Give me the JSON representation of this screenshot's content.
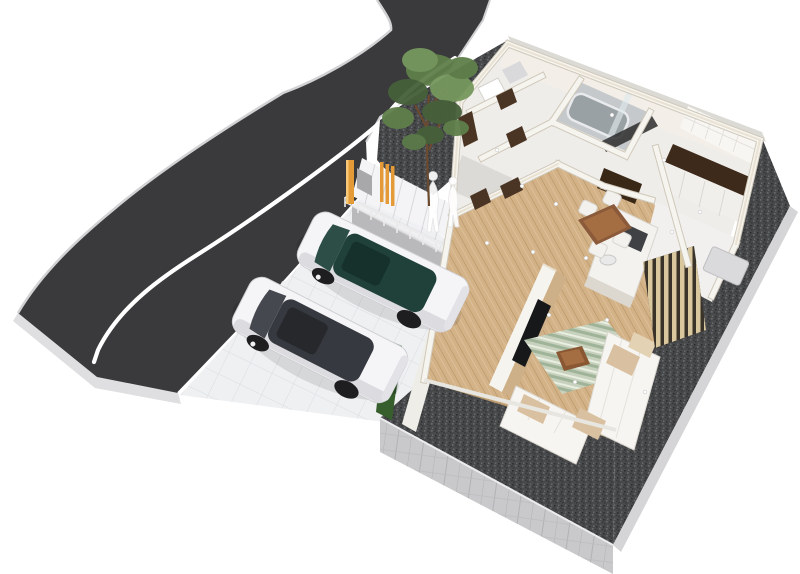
{
  "meta": {
    "title": "3D aerial cutaway floor-plan render of a house lot",
    "view": "perspective aerial oblique",
    "contains_text": false
  },
  "scene": {
    "road": {
      "label": "curved asphalt road",
      "marking": "single white lane line"
    },
    "driveway": {
      "label": "white tiled parking area at street level"
    },
    "vehicles": [
      {
        "label": "white SUV, dark teal glass roof, parked facing upper-left"
      },
      {
        "label": "white SUV, dark gray glass roof, parked facing upper-left"
      }
    ],
    "site": {
      "plinth": "raised base with concrete block face",
      "gravel": "dark gravel border around house",
      "stairs": "white entrance steps with metal handrail",
      "figures": "two translucent white human silhouettes on the steps",
      "gate": "orange wooden slat posts and gray meter box",
      "hedge": "green shrub strip beside driveway",
      "tree": "green garden tree by the road"
    },
    "house": {
      "style": "cutaway walls, open ceiling",
      "rooms": [
        "entrance hall",
        "corridor with brown doors",
        "bathroom with gray tub and glass screen",
        "washroom with dark brown counter",
        "kitchen with island and cooktop",
        "dining area",
        "living room"
      ],
      "furniture": [
        "brown dining table with four white chairs",
        "white kitchen island with dark cooktop",
        "angled TV partition wall with black TV",
        "white U-shaped sofa with beige cushions",
        "striped green rug",
        "brown coffee table",
        "wood slat screen",
        "outdoor unit"
      ]
    }
  },
  "colors": {
    "background": "#ffffff",
    "road": "#3a3a3d",
    "road_side": "#dfdfe1",
    "curb": "#d2d2d4",
    "lane_line": "#ffffff",
    "driveway": "#eef0f2",
    "concrete_wall": "#b9b9bb",
    "stair_white": "#f4f4f6",
    "rail_gray": "#eceained",
    "plinth": "#c9c9cb",
    "plinth_light": "#d5d5d7",
    "wall_face": "#f6f4ef",
    "wall_shadow": "#cfc8ba",
    "wall_top": "#e9e1d2",
    "back_face": "#f3efe8",
    "floor_back": "#efedea",
    "wood_floor": "#d3b287",
    "tile_floor": "#f1f0ee",
    "door_brown": "#4a3524",
    "cabinet_dark": "#3a2817",
    "counter_brown": "#3e2a1a",
    "bath_gray": "#c5c9cb",
    "tub_gray": "#9aa1a4",
    "sofa_white": "#f6f5f2",
    "cushion_beige": "#d9c0a0",
    "rug_green": "#c3cdb9",
    "table_brown": "#8a5a3a",
    "table_top": "#a56d42",
    "tv_black": "#17181a",
    "slat_wood": "#d9c79e",
    "car_white": "#f5f5f7",
    "glass_teal": "#20403a",
    "glass_gray": "#36393f",
    "wheel_dark": "#1e1e20",
    "tree_green": "#5f7f4a",
    "trunk_brown": "#6b4a2f",
    "hedge_green": "#375f2e",
    "post_orange": "#e59a38",
    "figure_white": "#ffffff"
  }
}
